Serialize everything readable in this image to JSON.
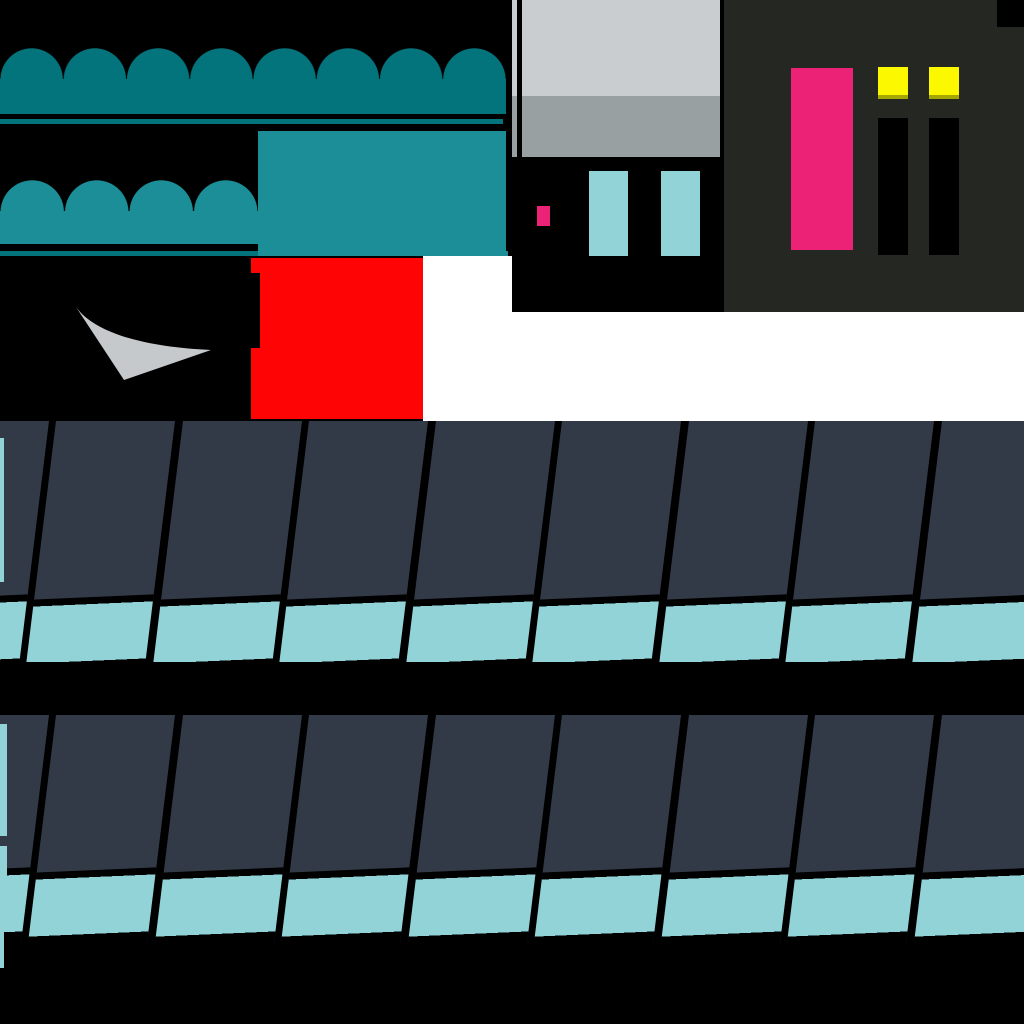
{
  "meta": {
    "kind": "game-texture-atlas",
    "canvas": {
      "width_px": 1024,
      "height_px": 1024
    }
  },
  "palette": {
    "black": "#000000",
    "white": "#ffffff",
    "teal_dark": "#03737c",
    "teal_light": "#1b8e97",
    "gray_light": "#c9cdd0",
    "gray_mid": "#99a0a2",
    "gray_sail": "#c5c9cb",
    "charcoal": "#242722",
    "pink": "#ec2276",
    "yellow": "#fbf800",
    "red": "#fe0404",
    "slate_panel": "#333a47",
    "cyan_light": "#92d3d7"
  },
  "sprites": [
    {
      "name": "awning-large",
      "desc": "8-bump scalloped awning",
      "color": "teal_dark",
      "bbox": [
        0,
        48,
        506,
        66
      ]
    },
    {
      "name": "awning-small",
      "desc": "4-bump scalloped awning",
      "color": "teal_light",
      "bbox": [
        0,
        180,
        258,
        64
      ]
    },
    {
      "name": "canopy-bar-1",
      "desc": "thin awning bar",
      "color": "teal_dark",
      "bbox": [
        0,
        119,
        503,
        5
      ]
    },
    {
      "name": "canopy-bar-2",
      "desc": "thin awning bar",
      "color": "teal_light",
      "bbox": [
        0,
        251,
        508,
        5
      ]
    },
    {
      "name": "canopy-panel",
      "desc": "solid awning panel",
      "color": "teal_light",
      "bbox": [
        258,
        131,
        248,
        125
      ]
    },
    {
      "name": "shop-window",
      "desc": "two-tone glass window with mullion",
      "colors": [
        "gray_light",
        "gray_mid"
      ],
      "bbox": [
        512,
        0,
        208,
        157
      ]
    },
    {
      "name": "pink-marker",
      "desc": "small pink chip",
      "color": "pink",
      "bbox": [
        537,
        206,
        13,
        20
      ]
    },
    {
      "name": "shutters",
      "desc": "two light-cyan shutters",
      "color": "cyan_light",
      "bbox": [
        589,
        171,
        111,
        85
      ]
    },
    {
      "name": "building-facade",
      "desc": "dark facade with pink door, lit and dark windows",
      "colors": [
        "charcoal",
        "pink",
        "yellow",
        "black"
      ],
      "bbox": [
        724,
        0,
        300,
        312
      ]
    },
    {
      "name": "red-block",
      "desc": "red rectangle with notched left edge",
      "color": "red",
      "bbox": [
        251,
        258,
        172,
        161
      ]
    },
    {
      "name": "sail-swoosh",
      "desc": "curved grey triangle",
      "color": "gray_sail",
      "bbox": [
        60,
        300,
        160,
        85
      ]
    },
    {
      "name": "roof-row-1",
      "desc": "slanted shingle panels with cyan eaves",
      "colors": [
        "slate_panel",
        "cyan_light"
      ],
      "bbox": [
        0,
        421,
        1024,
        241
      ]
    },
    {
      "name": "roof-row-2",
      "desc": "slanted shingle panels with cyan eaves",
      "colors": [
        "slate_panel",
        "cyan_light"
      ],
      "bbox": [
        0,
        715,
        1024,
        230
      ]
    }
  ]
}
